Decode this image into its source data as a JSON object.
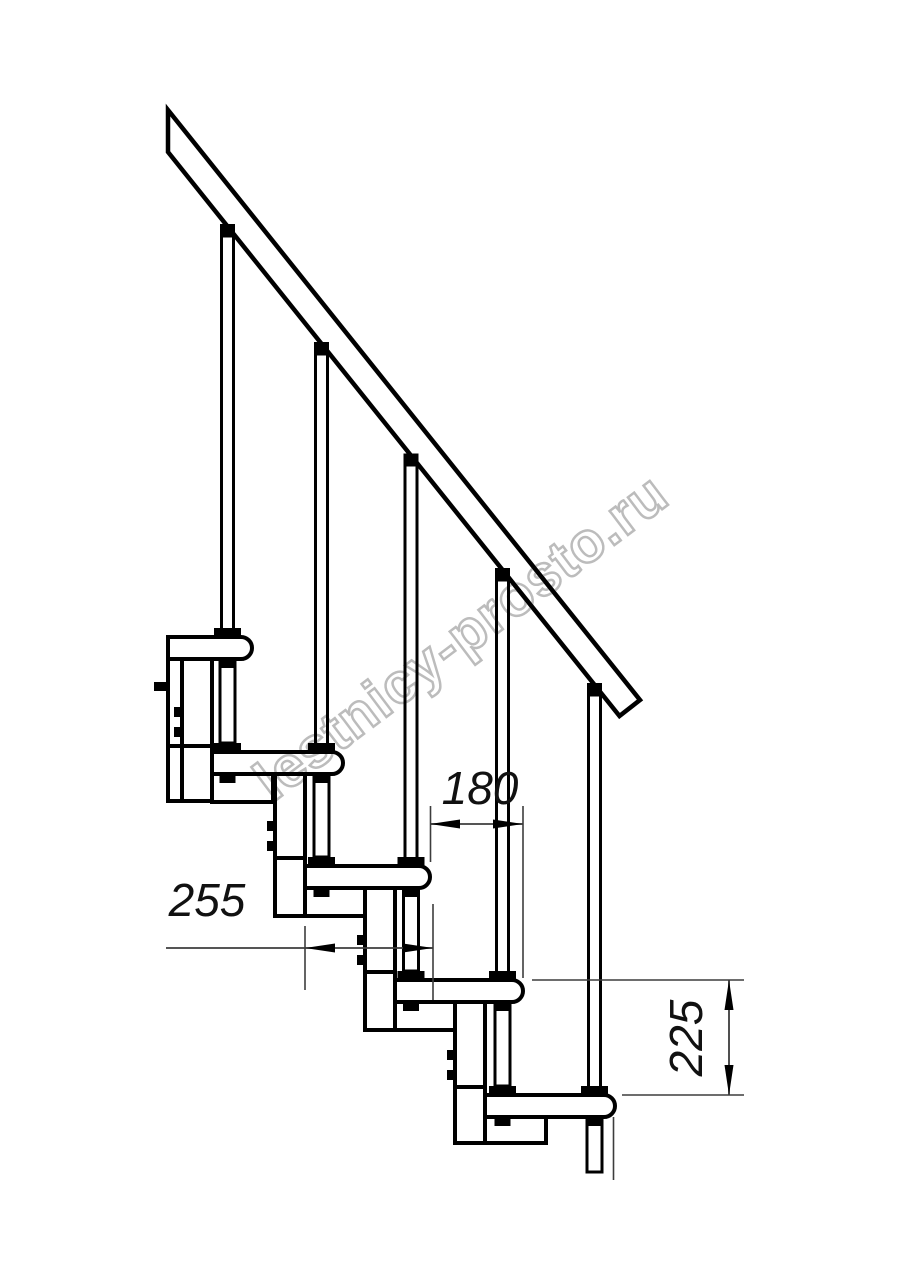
{
  "page": {
    "background": "#ffffff"
  },
  "drawing": {
    "type": "modular-staircase-side-view",
    "watermark": "lestnicy-prosto.ru",
    "dimensions": {
      "step_run_mm": "180",
      "tread_depth_mm": "255",
      "step_rise_mm": "225"
    },
    "colors": {
      "line": "#000000",
      "dimension_line": "#3d3d3d",
      "watermark": "#bcbcbc",
      "background": "#ffffff"
    }
  }
}
